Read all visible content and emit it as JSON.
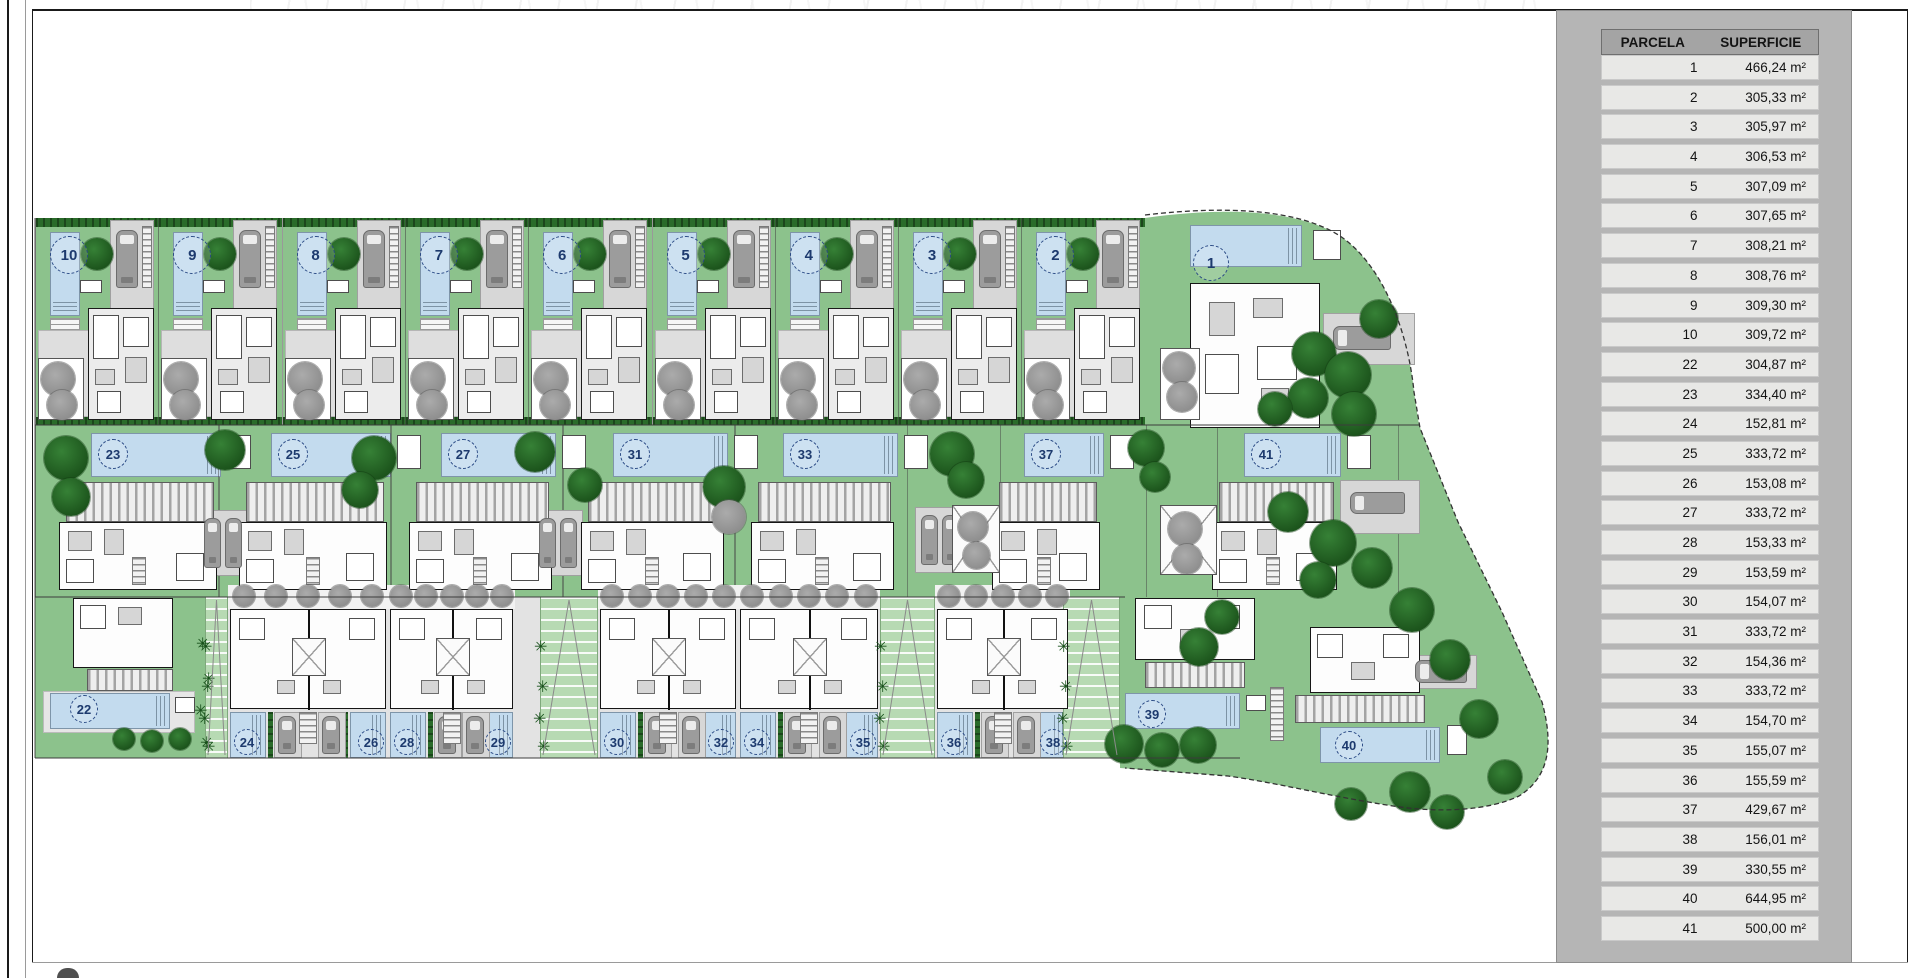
{
  "table": {
    "headers": [
      "PARCELA",
      "SUPERFICIE"
    ],
    "rows": [
      [
        "1",
        "466,24 m²"
      ],
      [
        "2",
        "305,33 m²"
      ],
      [
        "3",
        "305,97 m²"
      ],
      [
        "4",
        "306,53 m²"
      ],
      [
        "5",
        "307,09 m²"
      ],
      [
        "6",
        "307,65 m²"
      ],
      [
        "7",
        "308,21 m²"
      ],
      [
        "8",
        "308,76 m²"
      ],
      [
        "9",
        "309,30 m²"
      ],
      [
        "10",
        "309,72 m²"
      ],
      [
        "22",
        "304,87 m²"
      ],
      [
        "23",
        "334,40 m²"
      ],
      [
        "24",
        "152,81 m²"
      ],
      [
        "25",
        "333,72 m²"
      ],
      [
        "26",
        "153,08 m²"
      ],
      [
        "27",
        "333,72 m²"
      ],
      [
        "28",
        "153,33 m²"
      ],
      [
        "29",
        "153,59 m²"
      ],
      [
        "30",
        "154,07 m²"
      ],
      [
        "31",
        "333,72 m²"
      ],
      [
        "32",
        "154,36 m²"
      ],
      [
        "33",
        "333,72 m²"
      ],
      [
        "34",
        "154,70 m²"
      ],
      [
        "35",
        "155,07 m²"
      ],
      [
        "36",
        "155,59 m²"
      ],
      [
        "37",
        "429,67 m²"
      ],
      [
        "38",
        "156,01 m²"
      ],
      [
        "39",
        "330,55 m²"
      ],
      [
        "40",
        "644,95 m²"
      ],
      [
        "41",
        "500,00 m²"
      ]
    ]
  },
  "map": {
    "top_row_labels": [
      "10",
      "9",
      "8",
      "7",
      "6",
      "5",
      "4",
      "3",
      "2"
    ],
    "plot1_label": "1",
    "mid_row": [
      {
        "label": "23",
        "x": 35,
        "w": 183,
        "px": 55,
        "pw": 130
      },
      {
        "label": "25",
        "x": 218,
        "w": 172,
        "px": 52,
        "pw": 120
      },
      {
        "label": "27",
        "x": 390,
        "w": 172,
        "px": 50,
        "pw": 115
      },
      {
        "label": "31",
        "x": 562,
        "w": 172,
        "px": 50,
        "pw": 115
      },
      {
        "label": "33",
        "x": 734,
        "w": 172,
        "px": 48,
        "pw": 115
      },
      {
        "label": "37",
        "x": 1000,
        "w": 145,
        "px": 23,
        "pw": 80
      },
      {
        "label": "41",
        "x": 1217,
        "w": 180,
        "px": 26,
        "pw": 97
      }
    ],
    "bottom_pairs": [
      {
        "labels": [
          "24",
          "26"
        ],
        "x": 228,
        "w": 160
      },
      {
        "labels": [
          "28",
          "29"
        ],
        "x": 388,
        "w": 127
      },
      {
        "labels": [
          "30",
          "32"
        ],
        "x": 598,
        "w": 140
      },
      {
        "labels": [
          "34",
          "35"
        ],
        "x": 738,
        "w": 142
      },
      {
        "labels": [
          "36",
          "38"
        ],
        "x": 935,
        "w": 135
      }
    ],
    "plot22_label": "22",
    "plot39_label": "39",
    "plot40_label": "40"
  },
  "colors": {
    "grass": "#8cc28c",
    "walkway": "#b7dab3",
    "pool": "#c3dbee",
    "hedge": "#2a6b2a",
    "tree_dark": "#236223",
    "tree_gray": "#9a9a9a",
    "house_gray": "#e3e3e3",
    "car_gray": "#9c9c9c",
    "panel_gray": "#b5b5b5",
    "table_header_gray": "#a4a4a4",
    "table_row_gray": "#e8e8e6",
    "label_navy": "#1d3a6e"
  }
}
